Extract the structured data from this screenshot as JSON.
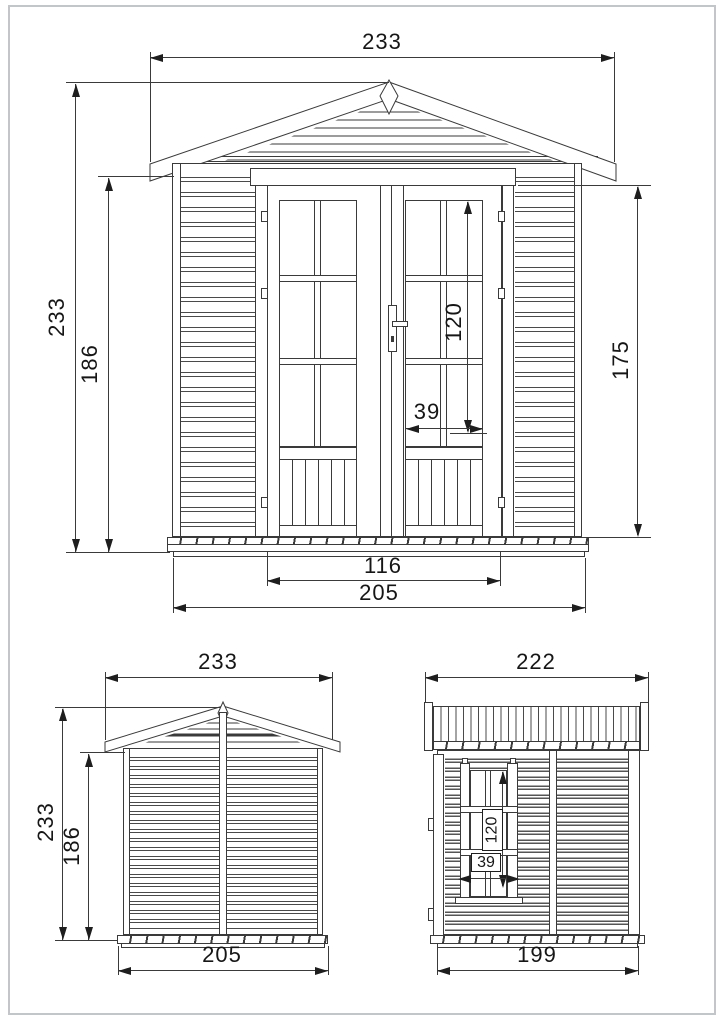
{
  "colors": {
    "background": "#ffffff",
    "page_border": "#c3c6c8",
    "drawing_line": "#3a3a3a",
    "dimension_text": "#161616"
  },
  "views": {
    "front": {
      "dims": {
        "roof_width": "233",
        "total_height": "233",
        "wall_height": "186",
        "door_height": "175",
        "glazing_height": "120",
        "glazing_width": "39",
        "door_width": "116",
        "base_width": "205"
      }
    },
    "back": {
      "dims": {
        "roof_width": "233",
        "total_height": "233",
        "wall_height": "186",
        "base_width": "205"
      }
    },
    "side": {
      "dims": {
        "roof_depth": "222",
        "window_height": "120",
        "window_width": "39",
        "base_depth": "199"
      }
    }
  }
}
